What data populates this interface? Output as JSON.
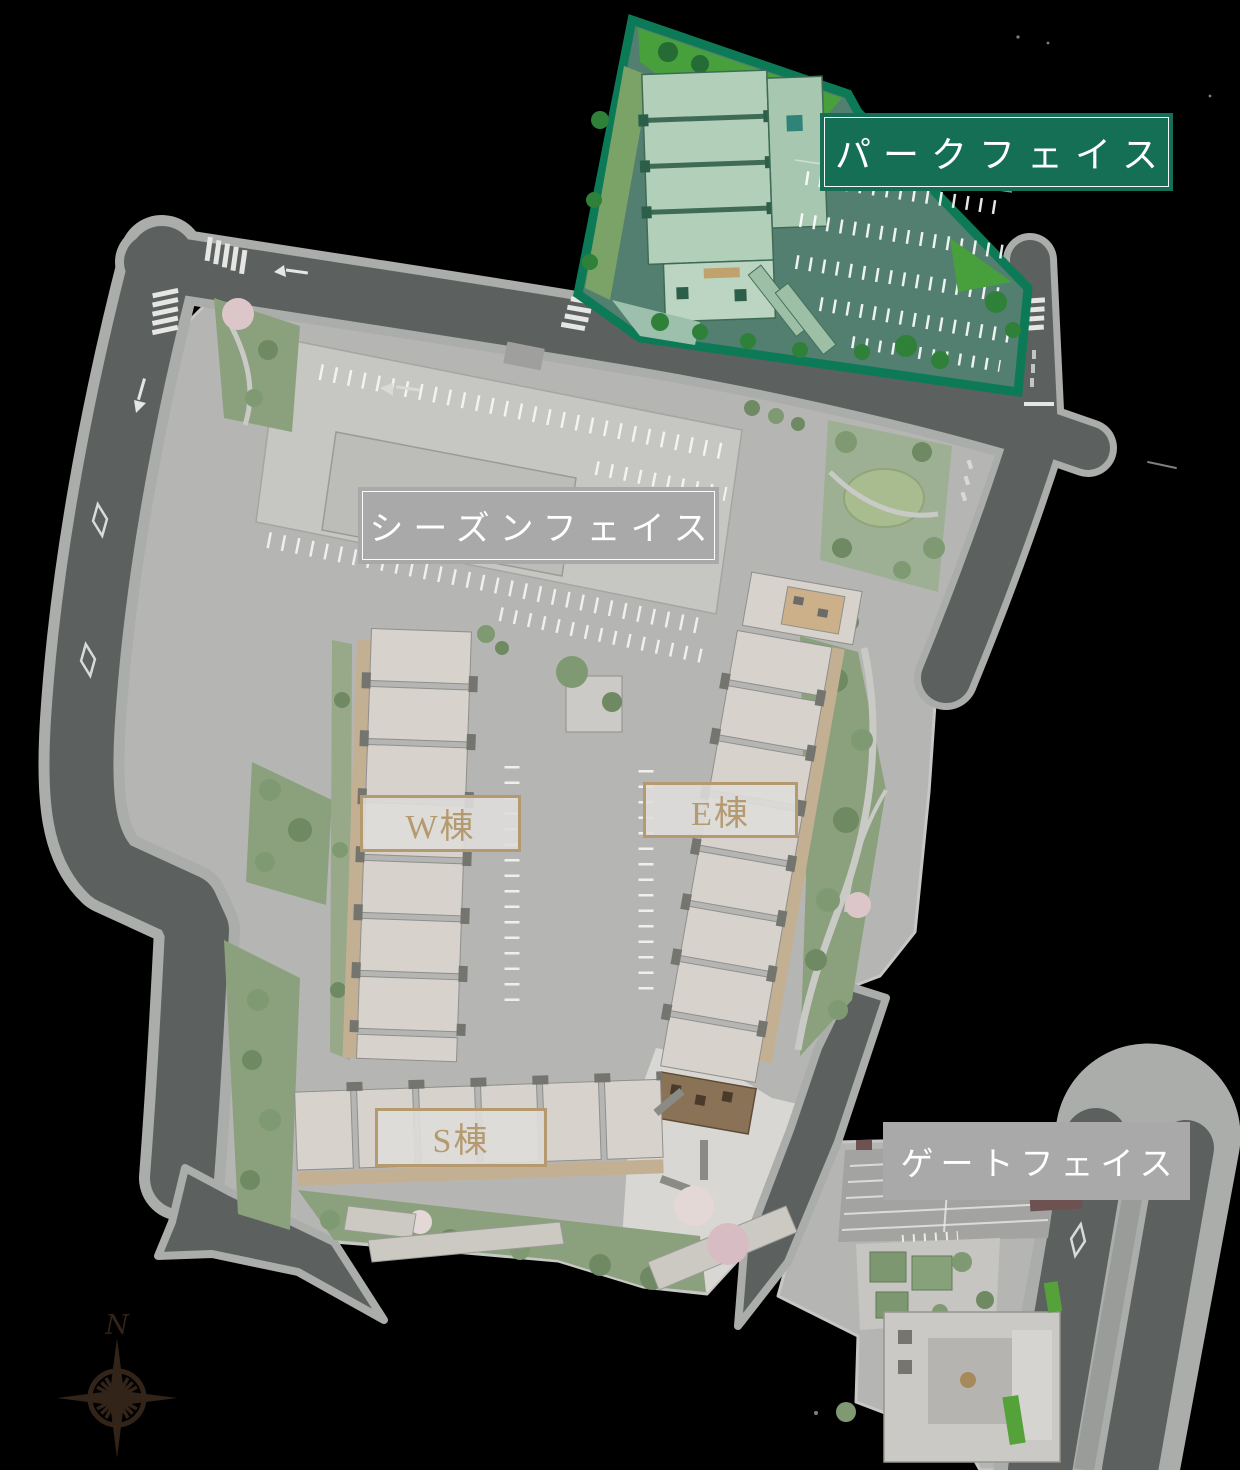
{
  "page": {
    "background_color": "#000000"
  },
  "site_map": {
    "areas": [
      {
        "id": "park-face",
        "label": "パークフェイス",
        "highlighted": true,
        "label_bg": "#156f55",
        "label_text_color": "#ffffff",
        "border_color": "#0c7a57",
        "bordered_label": true
      },
      {
        "id": "season-face",
        "label": "シーズンフェイス",
        "highlighted": false,
        "label_bg": "#a9a9a9",
        "label_text_color": "#ffffff",
        "bordered_label": true
      },
      {
        "id": "gate-face",
        "label": "ゲートフェイス",
        "highlighted": false,
        "label_bg": "#a9a9a9",
        "label_text_color": "#ffffff",
        "bordered_label": false
      }
    ],
    "buildings": [
      {
        "id": "w",
        "label": "W棟"
      },
      {
        "id": "e",
        "label": "E棟"
      },
      {
        "id": "s",
        "label": "S棟"
      }
    ],
    "building_label_style": {
      "bg": "rgba(222,221,218,0.9)",
      "accent": "#b49a6e"
    },
    "compass": {
      "label": "N",
      "color": "#33241a"
    },
    "palette": {
      "page_bg": "#000000",
      "road": "#5c615f",
      "sidewalk": "#abadaa",
      "ground": "#b5b6b3",
      "building": "#d7d3cc",
      "balcony": "#c3b093",
      "garden": "#8ba17d",
      "lawn": "#47a03c",
      "highlight_green": "#0c7a57",
      "tinted_ground": "#527f6f",
      "tinted_building": "#b2cfba"
    }
  }
}
